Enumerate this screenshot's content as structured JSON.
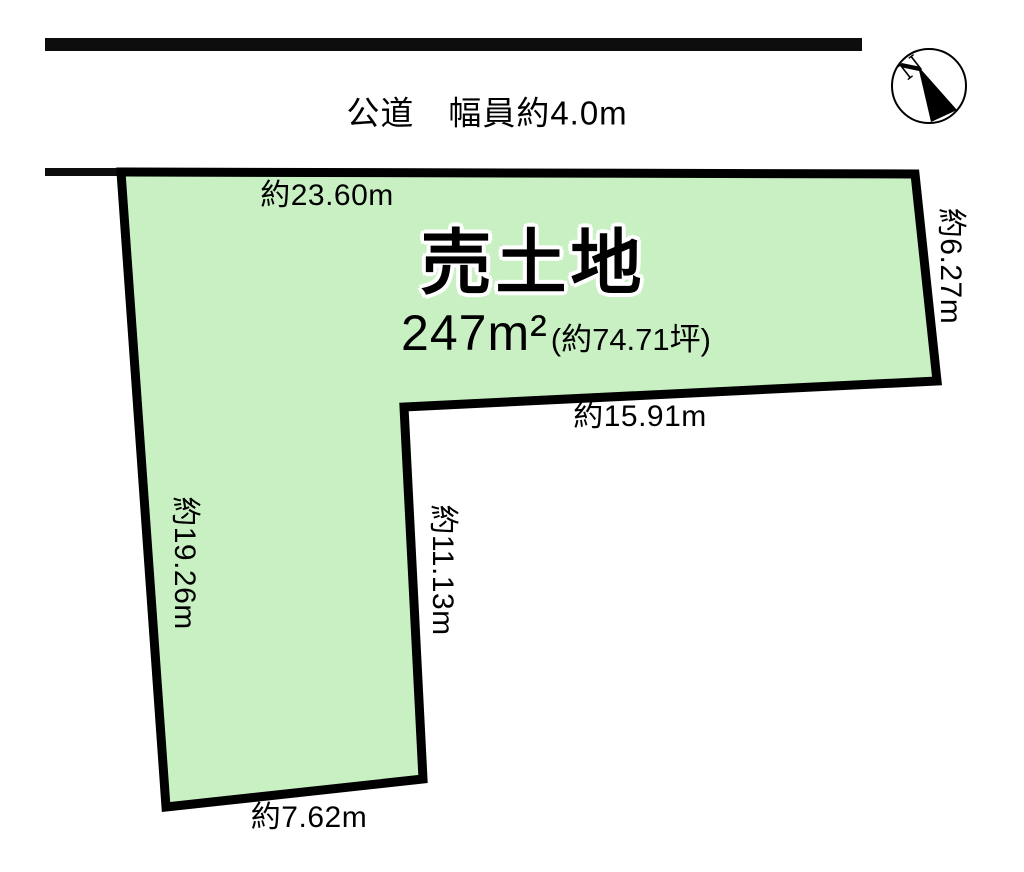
{
  "diagram": {
    "road_label": "公道　幅員約4.0m",
    "compass_north": "N",
    "title": "売土地",
    "area_main": "247m²",
    "area_sub": "(約74.71坪)",
    "dims": {
      "top": "約23.60m",
      "right": "約6.27m",
      "mid": "約15.91m",
      "inner": "約11.13m",
      "left": "約19.26m",
      "bottom": "約7.62m"
    },
    "colors": {
      "plot_fill": "#c9f0c3",
      "plot_stroke": "#000000",
      "road_line": "#0d0d0d",
      "compass_needle": "#000000"
    }
  }
}
